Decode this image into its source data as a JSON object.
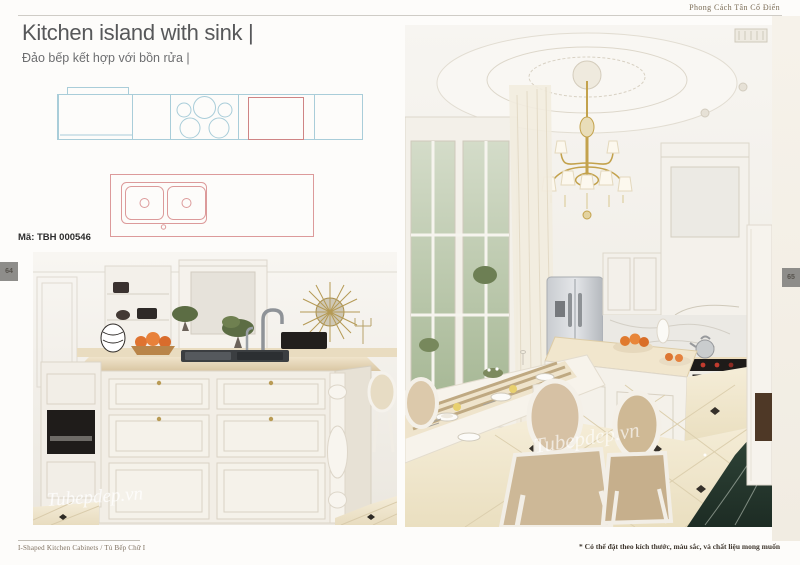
{
  "header": {
    "style_label": "Phong Cách Tân Cổ Điển"
  },
  "titles": {
    "title_en": "Kitchen island with sink |",
    "title_vi": "Đảo bếp kết hợp với bồn rửa |"
  },
  "product": {
    "code": "Mã: TBH 000546"
  },
  "pagination": {
    "left": "64",
    "right": "65"
  },
  "footer": {
    "left_caption": "I-Shaped Kitchen Cabinets  /  Tủ Bếp Chữ I",
    "right_note": "* Có thể đặt theo kích thước, màu sắc, và chất liệu mong muốn"
  },
  "watermark": "Tubepdep.vn",
  "drawings": {
    "counter_plan_color": "#a9cdd9",
    "sink_plan_color": "#dc9a9a",
    "items": [
      "counter-run-top-view",
      "island-double-sink-top-view"
    ]
  },
  "photos": {
    "left_subject": "kitchen-island-with-sink-render",
    "right_subject": "neoclassical-kitchen-dining-render"
  }
}
